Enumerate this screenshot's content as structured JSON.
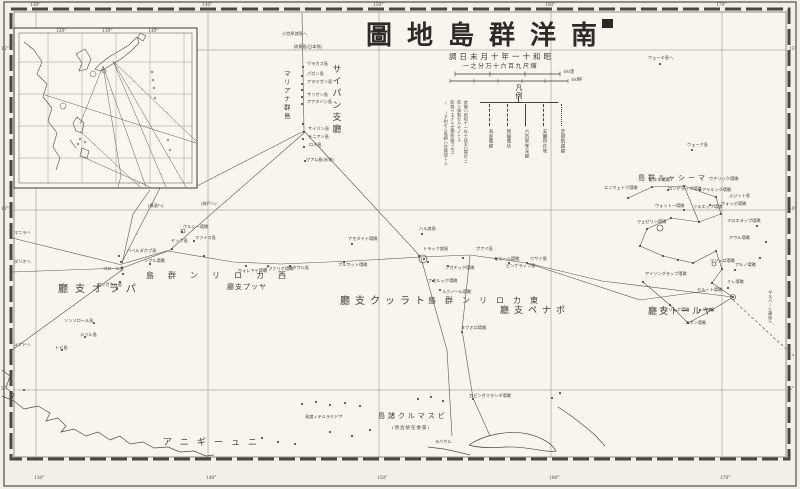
{
  "colors": {
    "ink": "#3b3832",
    "line": "#514d45",
    "faint": "#8a857b",
    "paper": "#f2efe7",
    "mapbg": "#f7f5ee"
  },
  "title": {
    "display": "圖地島群洋南",
    "reading": "南洋群島地圖"
  },
  "subtitle": {
    "date_display": "調日末月十年一十和昭",
    "date_reading": "昭和十一年十月末日調",
    "scale_display": "一之分万十六百九尺縮",
    "scale_reading": "縮尺九百六十万分之一"
  },
  "scalebars": {
    "miles_label": "100浬",
    "km_label": "500粁"
  },
  "legend": {
    "title": "凡例",
    "items": [
      {
        "label": "海底電線",
        "dash": "2,2"
      },
      {
        "label": "無線電信",
        "dash": "4,2"
      },
      {
        "label": "六百米等深線",
        "dash": "none"
      },
      {
        "label": "支廳所在地",
        "dash": "6,2"
      },
      {
        "label": "定期航路線",
        "dash": "1,2"
      }
    ],
    "notes": "本圖ハ昭和十一年十月末日現在ニ\n依リ調製セルモノトス\n航路ハ主ナル定期航路ヲ示ス\n( )ヲ附セル島嶼ハ外國領トス"
  },
  "graticule": {
    "lon_labels": [
      "130°",
      "140°",
      "150°",
      "160°",
      "170°"
    ],
    "lon_x": [
      36,
      208,
      379,
      551,
      722
    ],
    "lat_labels": [
      "15°",
      "10°",
      "5°"
    ],
    "lat_y": [
      50,
      210,
      390
    ]
  },
  "inset": {
    "lon_labels": [
      {
        "t": "120°",
        "x": 56
      },
      {
        "t": "130°",
        "x": 102
      },
      {
        "t": "140°",
        "x": 148
      }
    ]
  },
  "regions": [
    {
      "t": "サイパン支廳",
      "x": 336,
      "y": 64,
      "s": 9,
      "ls": 3,
      "v": 1,
      "name": "saipan-branch"
    },
    {
      "t": "マリアナ群島",
      "x": 285,
      "y": 70,
      "s": 6.5,
      "ls": 2,
      "v": 1,
      "name": "mariana-islands"
    },
    {
      "t": "廳支オラパ",
      "x": 58,
      "y": 290,
      "s": 10,
      "ls": 7,
      "name": "palau-branch"
    },
    {
      "t": "廳支プッヤ",
      "x": 227,
      "y": 288,
      "s": 7,
      "ls": 1,
      "name": "yap-branch"
    },
    {
      "t": "島群ンリロカ西",
      "x": 146,
      "y": 276,
      "s": 8,
      "ls": 14,
      "name": "west-caroline-islands"
    },
    {
      "t": "廳支クッラト",
      "x": 340,
      "y": 302,
      "s": 10,
      "ls": 5,
      "name": "truk-branch"
    },
    {
      "t": "島群ンリロカ東",
      "x": 428,
      "y": 301,
      "s": 8,
      "ls": 9,
      "name": "east-caroline-islands"
    },
    {
      "t": "廳支ペナポ",
      "x": 500,
      "y": 311,
      "s": 9,
      "ls": 5,
      "name": "ponape-branch"
    },
    {
      "t": "島群ルャシーマ",
      "x": 638,
      "y": 179,
      "s": 7,
      "ls": 3,
      "name": "marshall-islands"
    },
    {
      "t": "廳支トールヤ",
      "x": 648,
      "y": 312,
      "s": 9,
      "ls": 2,
      "name": "jaluit-branch"
    },
    {
      "t": "島諸クルマスビ",
      "x": 378,
      "y": 417,
      "s": 7,
      "ls": 3,
      "name": "bismarck-islands"
    },
    {
      "t": "(領治統任委豪)",
      "x": 392,
      "y": 428,
      "s": 4.5,
      "ls": 1,
      "name": "australian-mandate-note"
    },
    {
      "t": "アニギーュニ",
      "x": 163,
      "y": 443,
      "s": 9,
      "ls": 8,
      "name": "new-guinea"
    }
  ],
  "islands": [
    {
      "t": "小笠原諸島ヘ",
      "x": 282,
      "y": 34
    },
    {
      "t": "硫黄島(日本領)",
      "x": 294,
      "y": 47
    },
    {
      "t": "ウラカス島",
      "x": 307,
      "y": 64
    },
    {
      "t": "パガン島",
      "x": 307,
      "y": 74
    },
    {
      "t": "アラマガン島",
      "x": 307,
      "y": 82
    },
    {
      "t": "サリガン島",
      "x": 307,
      "y": 95
    },
    {
      "t": "アナタハン島",
      "x": 307,
      "y": 102
    },
    {
      "t": "サイパン島",
      "x": 308,
      "y": 129
    },
    {
      "t": "テニアン島",
      "x": 308,
      "y": 137
    },
    {
      "t": "ロタ島",
      "x": 309,
      "y": 145
    },
    {
      "t": "グアム島(米領)",
      "x": 306,
      "y": 160
    },
    {
      "t": "ウェーキ島ヘ",
      "x": 648,
      "y": 58
    },
    {
      "t": "ウェーク島",
      "x": 687,
      "y": 145
    },
    {
      "t": "バベルダオブ島",
      "x": 127,
      "y": 251
    },
    {
      "t": "コロール島",
      "x": 103,
      "y": 269
    },
    {
      "t": "アンガウル島",
      "x": 97,
      "y": 285
    },
    {
      "t": "ソンソロール島",
      "x": 64,
      "y": 321
    },
    {
      "t": "メリル島",
      "x": 80,
      "y": 335
    },
    {
      "t": "トビ島",
      "x": 55,
      "y": 348
    },
    {
      "t": "ヤップ島",
      "x": 171,
      "y": 241
    },
    {
      "t": "ウルシー環礁",
      "x": 183,
      "y": 227
    },
    {
      "t": "ファイス島",
      "x": 195,
      "y": 238
    },
    {
      "t": "ングル環礁",
      "x": 144,
      "y": 261
    },
    {
      "t": "ウォレアイ環礁",
      "x": 238,
      "y": 271
    },
    {
      "t": "イファリク環礁",
      "x": 264,
      "y": 269
    },
    {
      "t": "サタワル島",
      "x": 288,
      "y": 268
    },
    {
      "t": "プルワット環礁",
      "x": 338,
      "y": 265
    },
    {
      "t": "ナモヌイト環礁",
      "x": 348,
      "y": 239
    },
    {
      "t": "ハル諸島",
      "x": 419,
      "y": 229
    },
    {
      "t": "トラック諸島",
      "x": 423,
      "y": 249
    },
    {
      "t": "ナモルック環礁",
      "x": 428,
      "y": 281
    },
    {
      "t": "ルクノール環礁",
      "x": 442,
      "y": 292
    },
    {
      "t": "ンガチック環礁",
      "x": 445,
      "y": 268
    },
    {
      "t": "ポナペ島",
      "x": 476,
      "y": 249
    },
    {
      "t": "モキール環礁",
      "x": 494,
      "y": 259
    },
    {
      "t": "ピンゲラップ島",
      "x": 506,
      "y": 266
    },
    {
      "t": "クサイ島",
      "x": 530,
      "y": 259
    },
    {
      "t": "ヌクオロ環礁",
      "x": 461,
      "y": 328
    },
    {
      "t": "カピンガマランギ環礁",
      "x": 469,
      "y": 396
    },
    {
      "t": "エニウェトク環礁",
      "x": 604,
      "y": 188
    },
    {
      "t": "ビキニ環礁",
      "x": 649,
      "y": 180
    },
    {
      "t": "ロンゲラップ環礁",
      "x": 668,
      "y": 189
    },
    {
      "t": "ウォットー環礁",
      "x": 655,
      "y": 206
    },
    {
      "t": "クェゼリン環礁",
      "x": 637,
      "y": 222
    },
    {
      "t": "ウチリック環礁",
      "x": 709,
      "y": 179
    },
    {
      "t": "アイルック環礁",
      "x": 702,
      "y": 190
    },
    {
      "t": "メジット島",
      "x": 729,
      "y": 196
    },
    {
      "t": "リキエップ環礁",
      "x": 693,
      "y": 207
    },
    {
      "t": "ウォッゼ環礁",
      "x": 721,
      "y": 204
    },
    {
      "t": "マロエラップ環礁",
      "x": 727,
      "y": 221
    },
    {
      "t": "アウル環礁",
      "x": 729,
      "y": 238
    },
    {
      "t": "マジュロ環礁",
      "x": 710,
      "y": 261
    },
    {
      "t": "アルノ環礁",
      "x": 735,
      "y": 265
    },
    {
      "t": "ミレ環礁",
      "x": 727,
      "y": 282
    },
    {
      "t": "ヤルート環礁",
      "x": 697,
      "y": 290
    },
    {
      "t": "アイリングラップ環礁",
      "x": 645,
      "y": 274
    },
    {
      "t": "ナモリック環礁",
      "x": 660,
      "y": 310
    },
    {
      "t": "エボン環礁",
      "x": 685,
      "y": 323
    },
    {
      "t": "キリ島",
      "x": 702,
      "y": 310
    },
    {
      "t": "島諸ィテルラミドア",
      "x": 305,
      "y": 417
    },
    {
      "t": "ラバウル",
      "x": 435,
      "y": 442
    },
    {
      "t": "ギルバート諸島ヘ",
      "x": 770,
      "y": 290,
      "v": 1
    },
    {
      "t": "(横濱ヘ)",
      "x": 148,
      "y": 206
    },
    {
      "t": "(神戸ヘ)",
      "x": 201,
      "y": 204
    },
    {
      "t": "マニラヘ",
      "x": 14,
      "y": 233
    },
    {
      "t": "ダバオヘ",
      "x": 14,
      "y": 262
    },
    {
      "t": "メナドヘ",
      "x": 14,
      "y": 345
    }
  ]
}
